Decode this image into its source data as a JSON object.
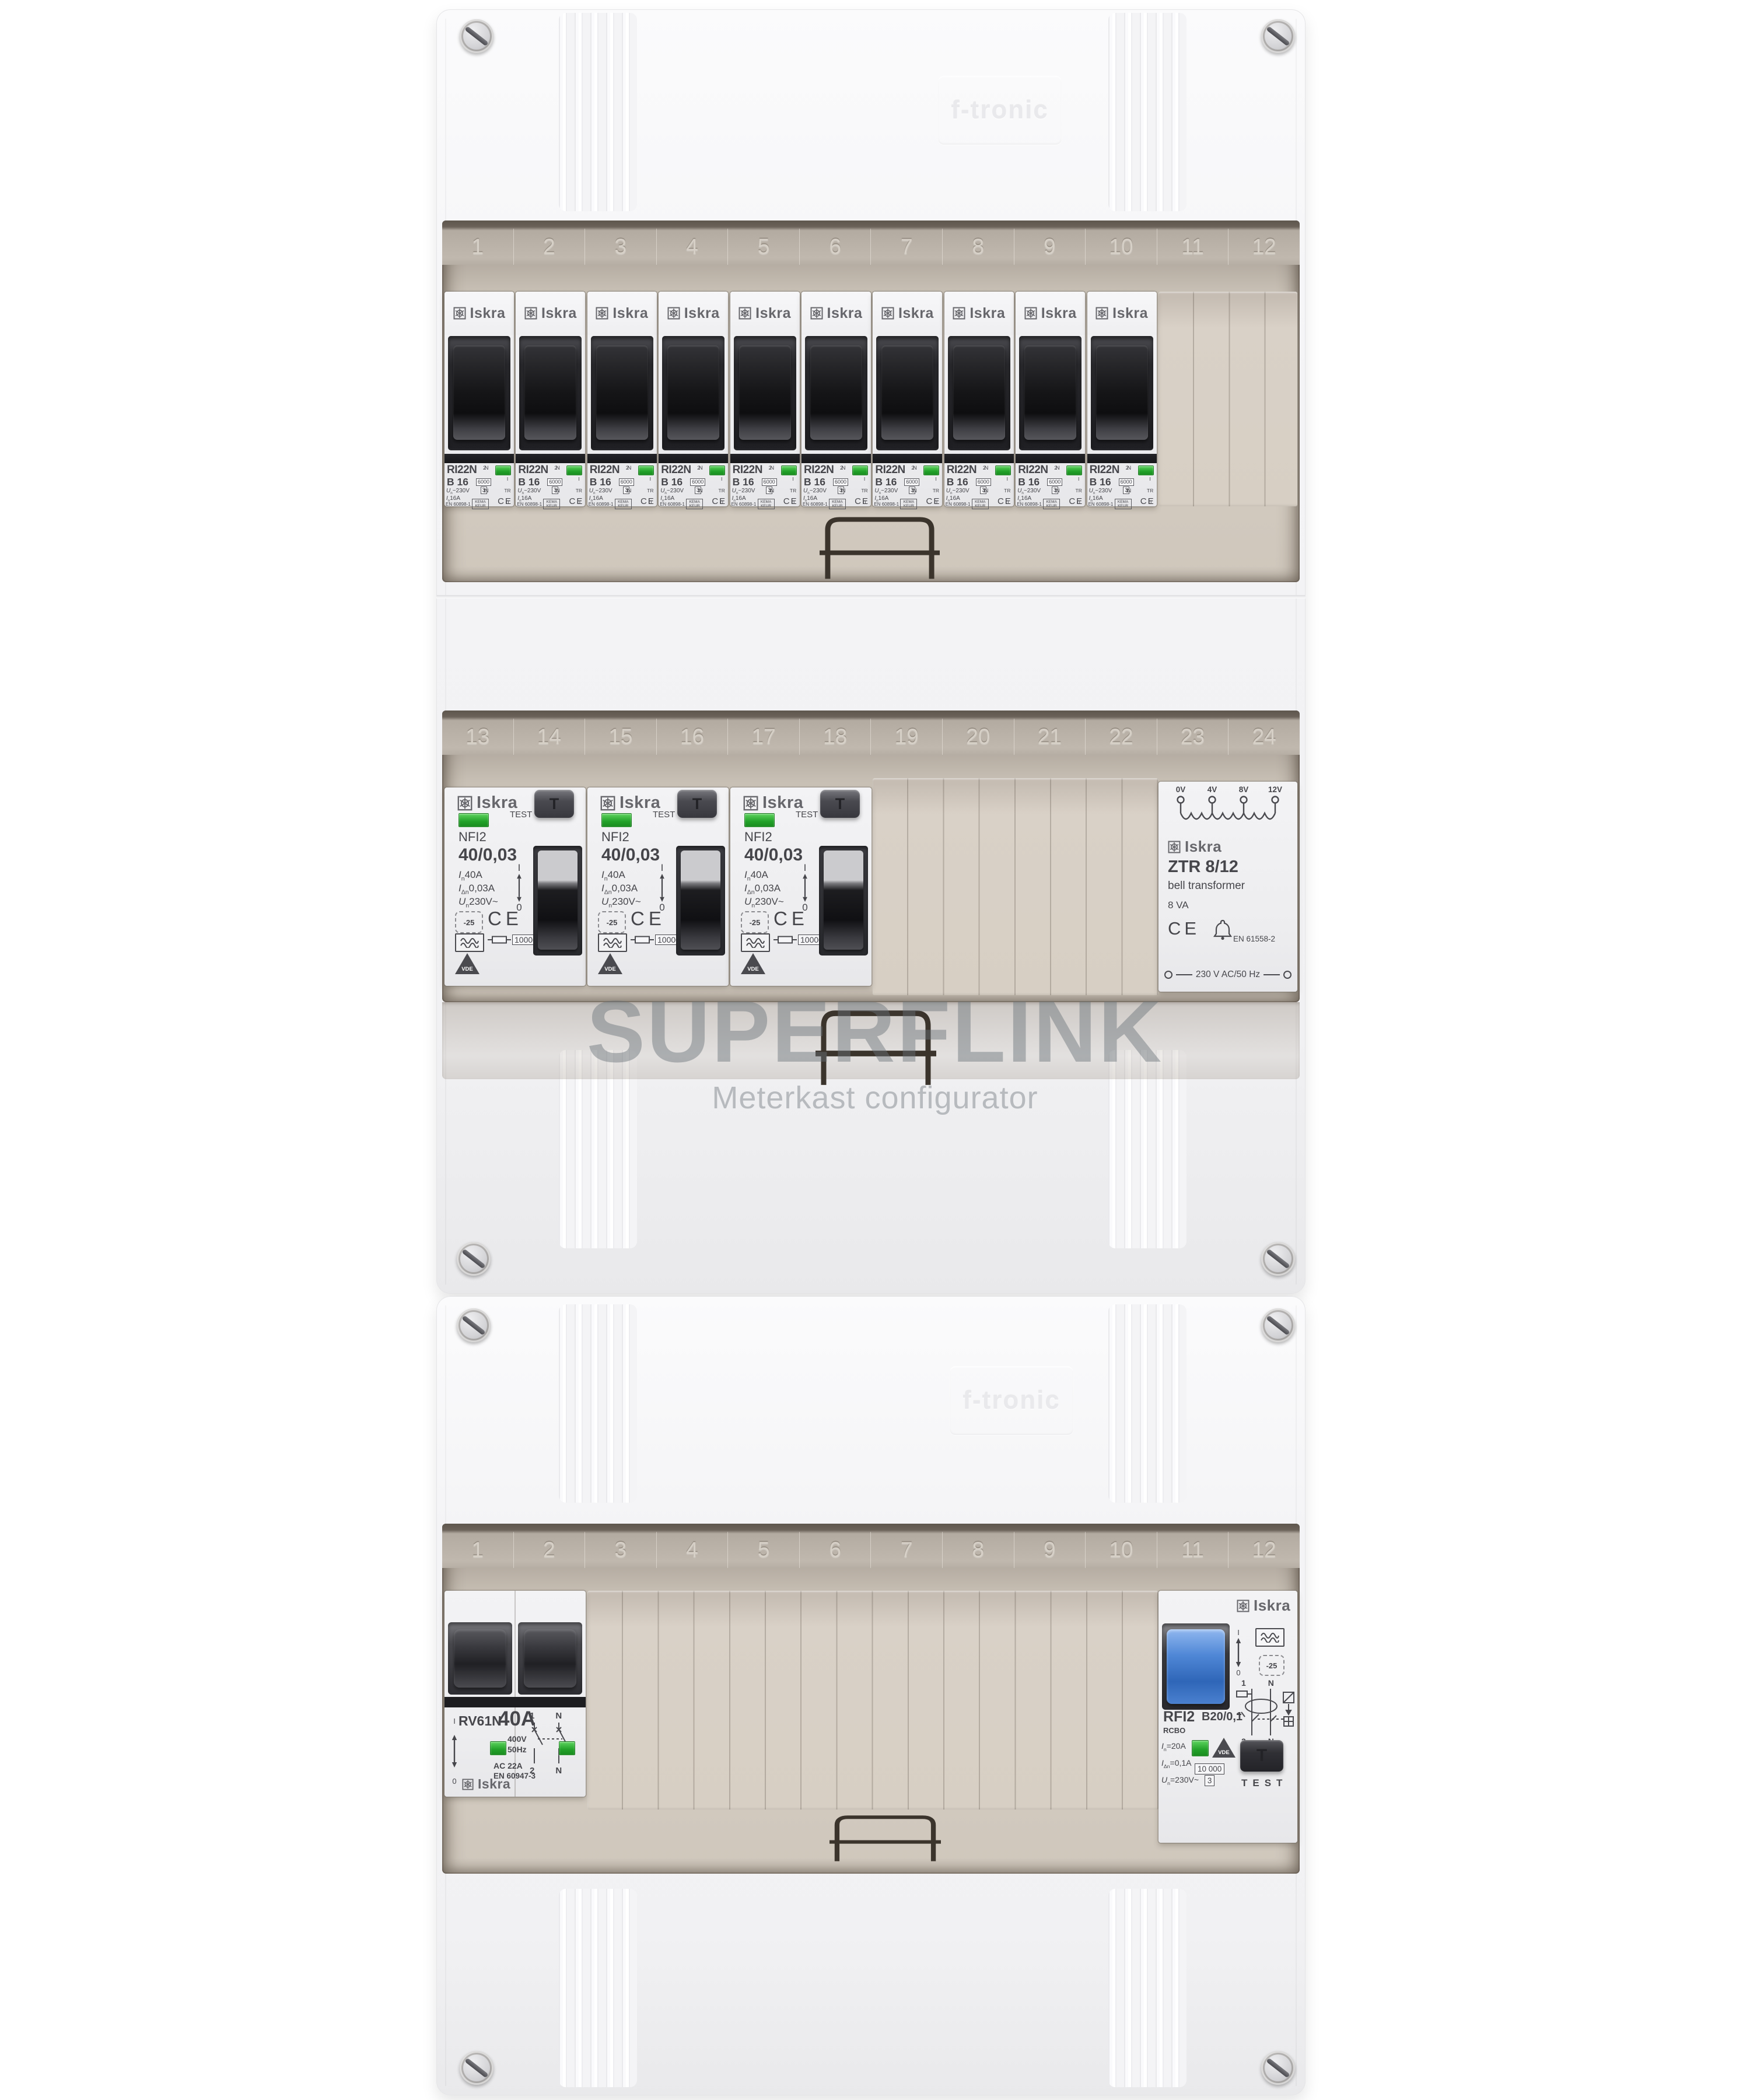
{
  "watermark": {
    "title": "SUPERFLINK",
    "subtitle": "Meterkast configurator"
  },
  "enclosure": {
    "brand_embossed": "f-tronic",
    "rows": [
      {
        "numbers": [
          "1",
          "2",
          "3",
          "4",
          "5",
          "6",
          "7",
          "8",
          "9",
          "10",
          "11",
          "12"
        ]
      },
      {
        "numbers": [
          "13",
          "14",
          "15",
          "16",
          "17",
          "18",
          "19",
          "20",
          "21",
          "22",
          "23",
          "24"
        ]
      },
      {
        "numbers": [
          "1",
          "2",
          "3",
          "4",
          "5",
          "6",
          "7",
          "8",
          "9",
          "10",
          "11",
          "12"
        ]
      }
    ]
  },
  "colors": {
    "led_green": "#2fae39",
    "toggle_blue": "#4586d8",
    "window_beige": "#d2cabf",
    "smoke": "#6f665d"
  },
  "mcb": {
    "count": 10,
    "brand": "Iskra",
    "model": "RI22N",
    "rating": "B 16",
    "un_prefix": "U",
    "un_sub": "n",
    "un_value": " ~230V",
    "in_prefix": "I",
    "in_sub": "n",
    "in_value": " 16A",
    "standard": "EN 60898-1",
    "breaking_capacity": "6000",
    "breaking_class": "3",
    "cert_kema": "KEMA KEUR",
    "ce": "CE",
    "term_top_num": "2",
    "term_top_n": "N",
    "term_bot_num": "1",
    "term_bot_n": "N",
    "pos_on": "I",
    "pos_trip": "TR",
    "pos_off": "0"
  },
  "rcd": {
    "count": 3,
    "brand": "Iskra",
    "test_label": "TEST",
    "test_button": "T",
    "model": "NFI2",
    "rating": "40/0,03",
    "in_prefix": "I",
    "in_sub": "n",
    "in_value": " 40A",
    "idn_prefix": "I",
    "idn_sub": "Δn",
    "idn_value": " 0,03A",
    "un_prefix": "U",
    "un_sub": "n",
    "un_value": " 230V~",
    "temp": "-25",
    "ce": "CE",
    "surge": "10000",
    "cert_vde": "VDE",
    "pos_on": "I",
    "pos_off": "0"
  },
  "transformer": {
    "taps": [
      "0V",
      "4V",
      "8V",
      "12V"
    ],
    "brand": "Iskra",
    "model": "ZTR 8/12",
    "type": "bell transformer",
    "power": "8 VA",
    "ce": "CE",
    "standard": "EN 61558-2",
    "supply": "230 V AC/50 Hz"
  },
  "main_switch": {
    "model": "RV61N",
    "rating": "40A",
    "voltage": "400V",
    "freq": "50Hz",
    "ac": "AC 22A",
    "standard": "EN 60947-3",
    "brand": "Iskra",
    "t1": "1",
    "t1n": "N",
    "t2": "2",
    "t2n": "N",
    "pos_on": "I",
    "pos_off": "0"
  },
  "rcbo": {
    "brand": "Iskra",
    "model": "RFI2",
    "rating": "B20/0,1",
    "type": "RCBO",
    "in_prefix": "I",
    "in_sub": "n",
    "in_value": "=20A",
    "idn_prefix": "I",
    "idn_sub": "Δn",
    "idn_value": "=0,1A",
    "un_prefix": "U",
    "un_sub": "n",
    "un_value": "=230V~",
    "surge": "10 000",
    "surge_class": "3",
    "temp": "-25",
    "test_button": "T",
    "test_label": "TEST",
    "cert_vde": "VDE",
    "t1": "1",
    "t1n": "N",
    "t2": "2",
    "t2n": "N",
    "pos_on": "I",
    "pos_off": "0"
  }
}
